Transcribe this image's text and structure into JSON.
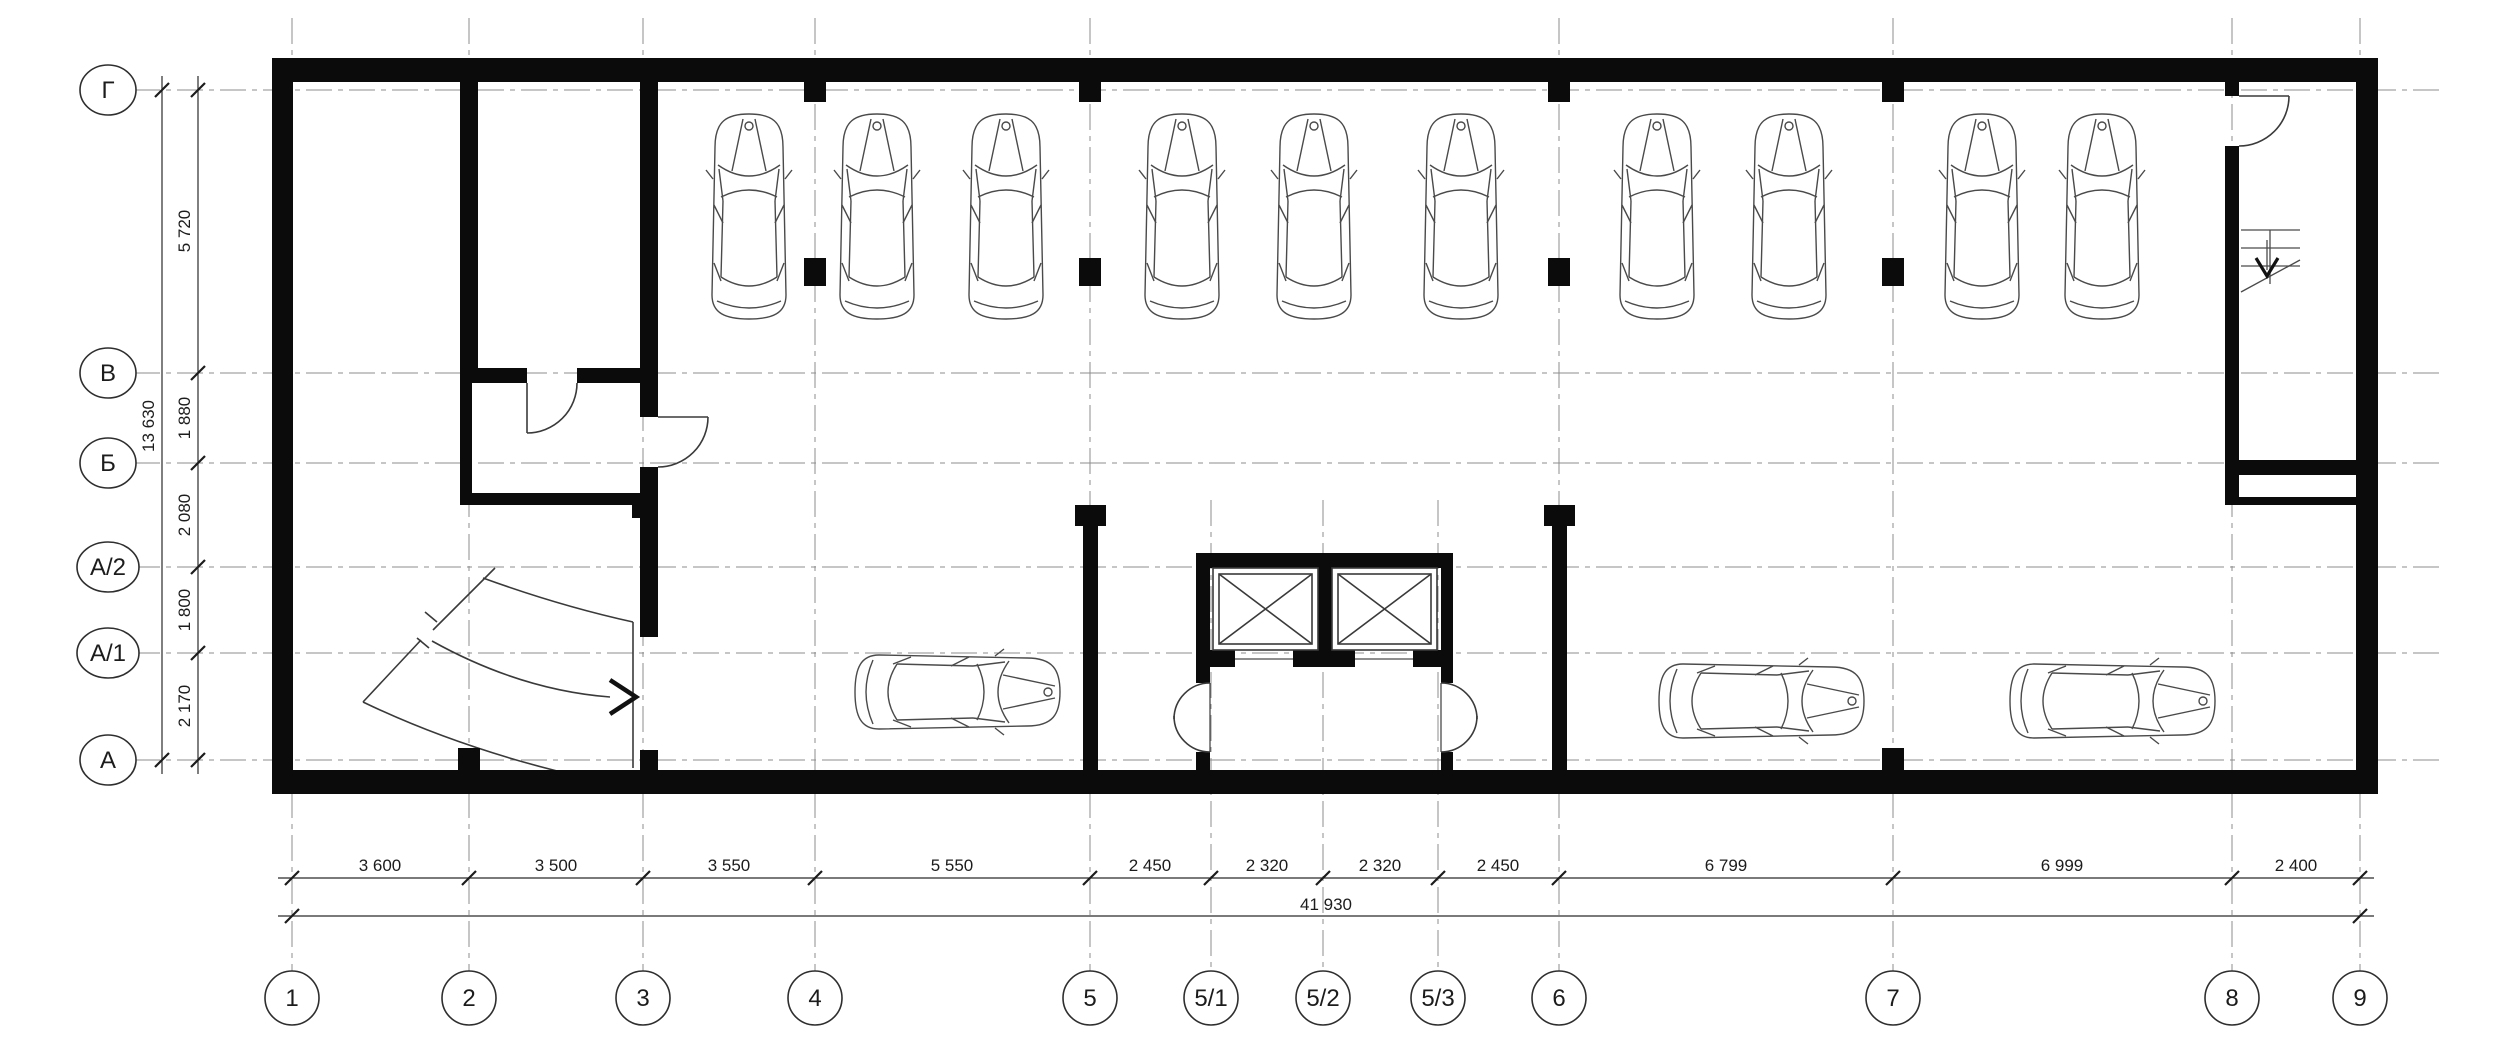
{
  "drawing": {
    "type": "parking-garage-floor-plan",
    "background": "#ffffff",
    "line_color": "#1c1c1c",
    "wall_color": "#0b0b0b"
  },
  "axes": {
    "rows": [
      {
        "label": "Г"
      },
      {
        "label": "В"
      },
      {
        "label": "Б"
      },
      {
        "label": "А/2"
      },
      {
        "label": "А/1"
      },
      {
        "label": "А"
      }
    ],
    "cols": [
      {
        "label": "1"
      },
      {
        "label": "2"
      },
      {
        "label": "3"
      },
      {
        "label": "4"
      },
      {
        "label": "5"
      },
      {
        "label": "5/1"
      },
      {
        "label": "5/2"
      },
      {
        "label": "5/3"
      },
      {
        "label": "6"
      },
      {
        "label": "7"
      },
      {
        "label": "8"
      },
      {
        "label": "9"
      }
    ]
  },
  "dims": {
    "bottom": [
      "3 600",
      "3 500",
      "3 550",
      "5 550",
      "2 450",
      "2 320",
      "2 320",
      "2 450",
      "6 799",
      "6 999",
      "2 400"
    ],
    "bottom_total": "41 930",
    "left": [
      "5 720",
      "1 880",
      "2 080",
      "1 800",
      "2 170"
    ],
    "left_total": "13 630"
  },
  "icons": {
    "car": "car-top-view",
    "elevator": "elevator-shaft-x",
    "stairs": "stairs-down-arrow",
    "ramp": "ramp-direction-arrow",
    "door": "door-swing-arc"
  },
  "summary": {
    "cars_top_row": 10,
    "cars_bottom_row": 3,
    "elevators": 2
  }
}
